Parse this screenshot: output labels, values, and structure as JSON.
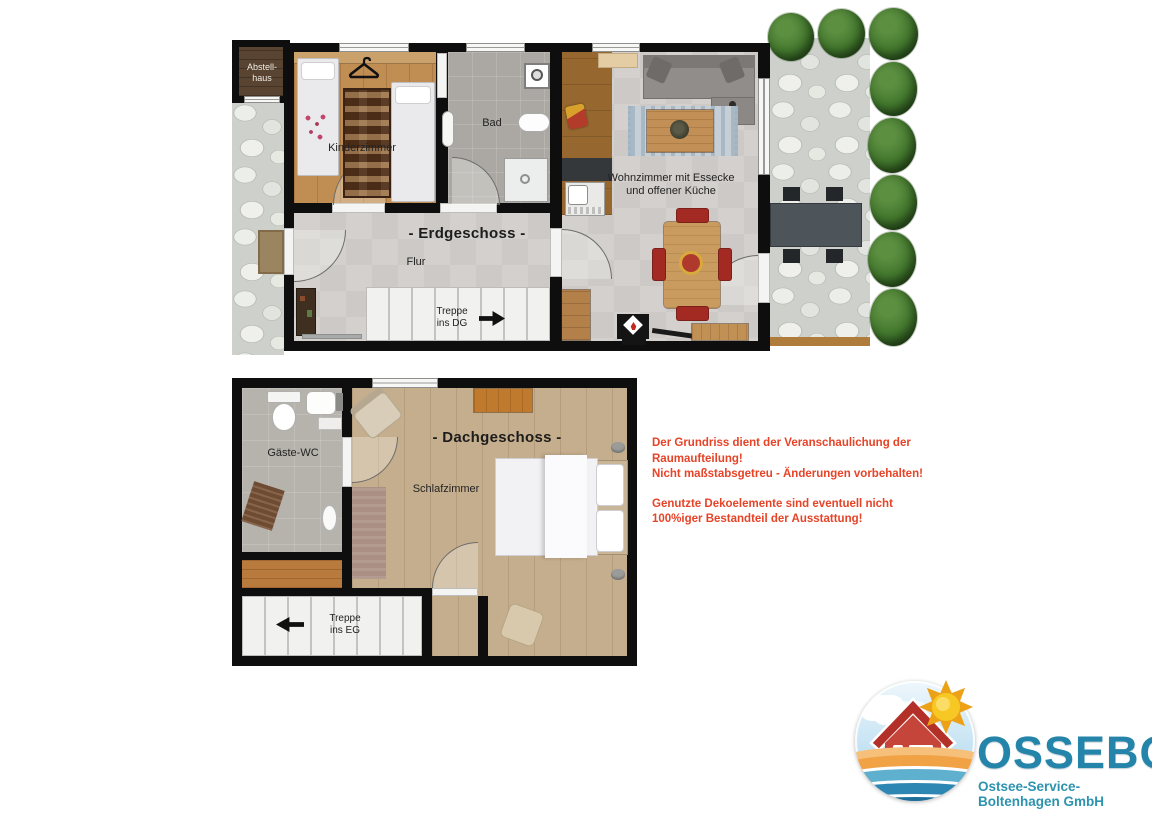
{
  "floor_plans": {
    "erdgeschoss": {
      "title": "- Erdgeschoss -",
      "rooms": {
        "abstellhaus": "Abstell-\nhaus",
        "kinderzimmer": "Kinderzimmer",
        "bad": "Bad",
        "wohnzimmer": "Wohnzimmer mit Essecke\nund offener Küche",
        "flur": "Flur"
      },
      "stairs_label": "Treppe\nins DG"
    },
    "dachgeschoss": {
      "title": "- Dachgeschoss -",
      "rooms": {
        "gaeste_wc": "Gäste-WC",
        "schlafzimmer": "Schlafzimmer"
      },
      "stairs_label": "Treppe\nins EG"
    }
  },
  "disclaimer": {
    "paragraph1": "Der Grundriss dient der Veranschaulichung der\nRaumaufteilung!\nNicht maßstabsgetreu - Änderungen vorbehalten!",
    "paragraph2": "Genutzte Dekoelemente sind eventuell nicht\n100%iger Bestandteil der Ausstattung!"
  },
  "logo": {
    "company": "OSSEBO",
    "subtitle": "Ostsee-Service-Boltenhagen GmbH"
  },
  "colors": {
    "wall_black": "#0e0e0e",
    "disclaimer_red": "#e64327",
    "logo_teal": "#2484a9",
    "chair_red": "#a32a23",
    "bush_green": "#41762c"
  }
}
